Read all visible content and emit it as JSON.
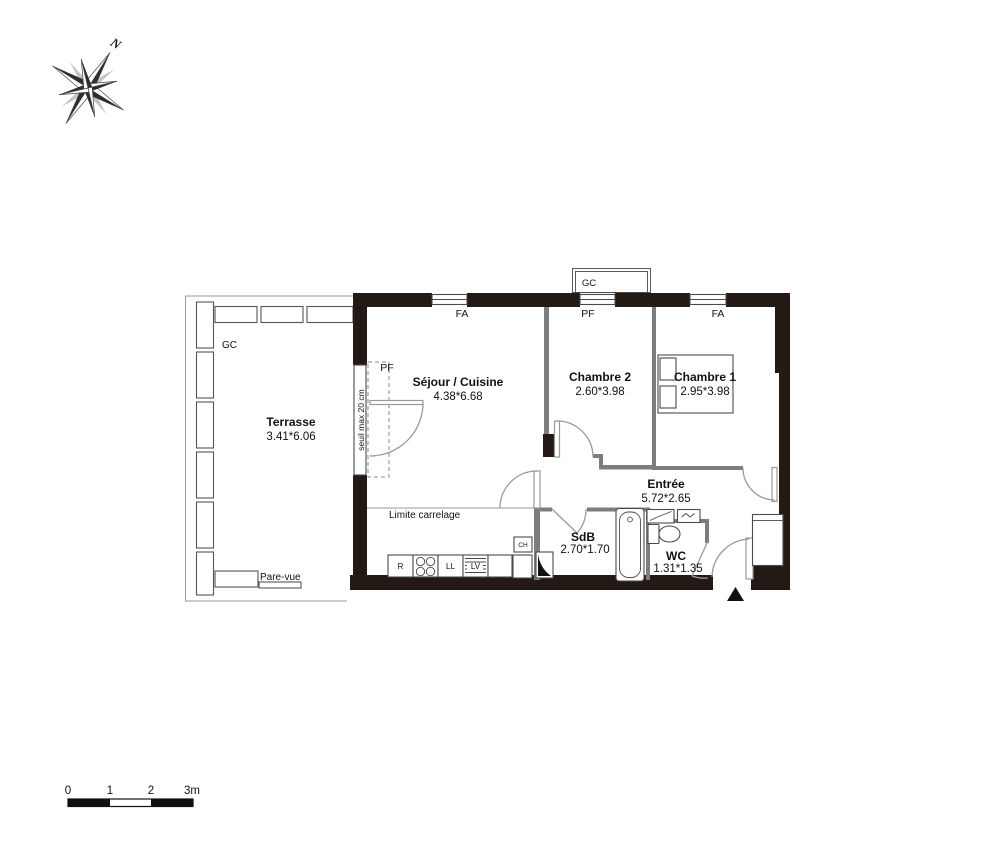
{
  "compass": {
    "north_label": "N"
  },
  "floorplan": {
    "rooms": [
      {
        "name": "Terrasse",
        "dims": "3.41*6.06"
      },
      {
        "name": "Séjour / Cuisine",
        "dims": "4.38*6.68"
      },
      {
        "name": "Chambre 2",
        "dims": "2.60*3.98"
      },
      {
        "name": "Chambre 1",
        "dims": "2.95*3.98"
      },
      {
        "name": "Entrée",
        "dims": "5.72*2.65"
      },
      {
        "name": "SdB",
        "dims": "2.70*1.70"
      },
      {
        "name": "WC",
        "dims": "1.31*1.35"
      }
    ],
    "window_labels": {
      "fa_left": "FA",
      "pf_center": "PF",
      "fa_right": "FA",
      "pf_terrace": "PF"
    },
    "duct_labels": {
      "gc_terrace": "GC",
      "gc_top": "GC"
    },
    "annotations": {
      "seuil": "seuil max 20 cm",
      "limite_carrelage": "Limite carrelage",
      "pare_vue": "Pare-vue"
    },
    "appliances": {
      "fridge": "R",
      "washing_machine": "LL",
      "dishwasher": "LV",
      "water_heater": "CH"
    }
  },
  "scale_bar": {
    "tick_labels": [
      "0",
      "1",
      "2",
      "3m"
    ]
  }
}
